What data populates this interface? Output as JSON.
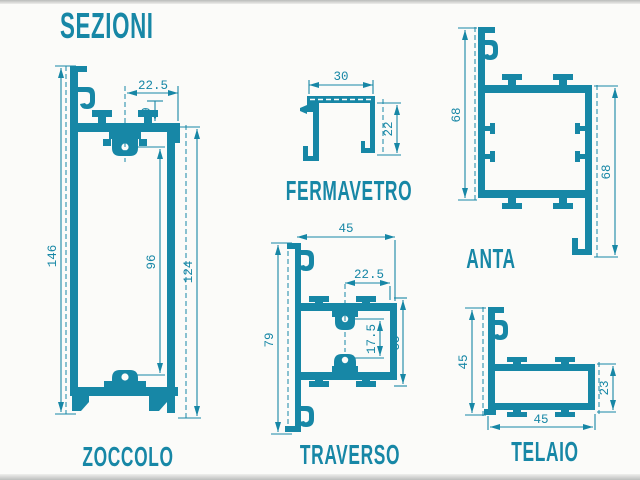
{
  "title": "SEZIONI",
  "colors": {
    "accent": "#1787a6",
    "background": "#fbfbf9",
    "edge_gray": "#c3c5c4"
  },
  "profiles": {
    "zoccolo": {
      "label": "ZOCCOLO",
      "dims": {
        "half_width": "22.5",
        "tab_inset": "9",
        "overall_height": "146",
        "clip_span": "96",
        "right_height": "124"
      }
    },
    "fermavetro": {
      "label": "FERMAVETRO",
      "dims": {
        "width": "30",
        "height": "22"
      }
    },
    "traverso": {
      "label": "TRAVERSO",
      "dims": {
        "width": "45",
        "half_width": "22.5",
        "overall_height": "79",
        "clip_span": "17.5",
        "box_height": "35"
      }
    },
    "anta": {
      "label": "ANTA",
      "dims": {
        "left_height": "68",
        "right_height": "68"
      }
    },
    "telaio": {
      "label": "TELAIO",
      "dims": {
        "left_height": "45",
        "box_height": "23",
        "width": "45"
      }
    }
  }
}
